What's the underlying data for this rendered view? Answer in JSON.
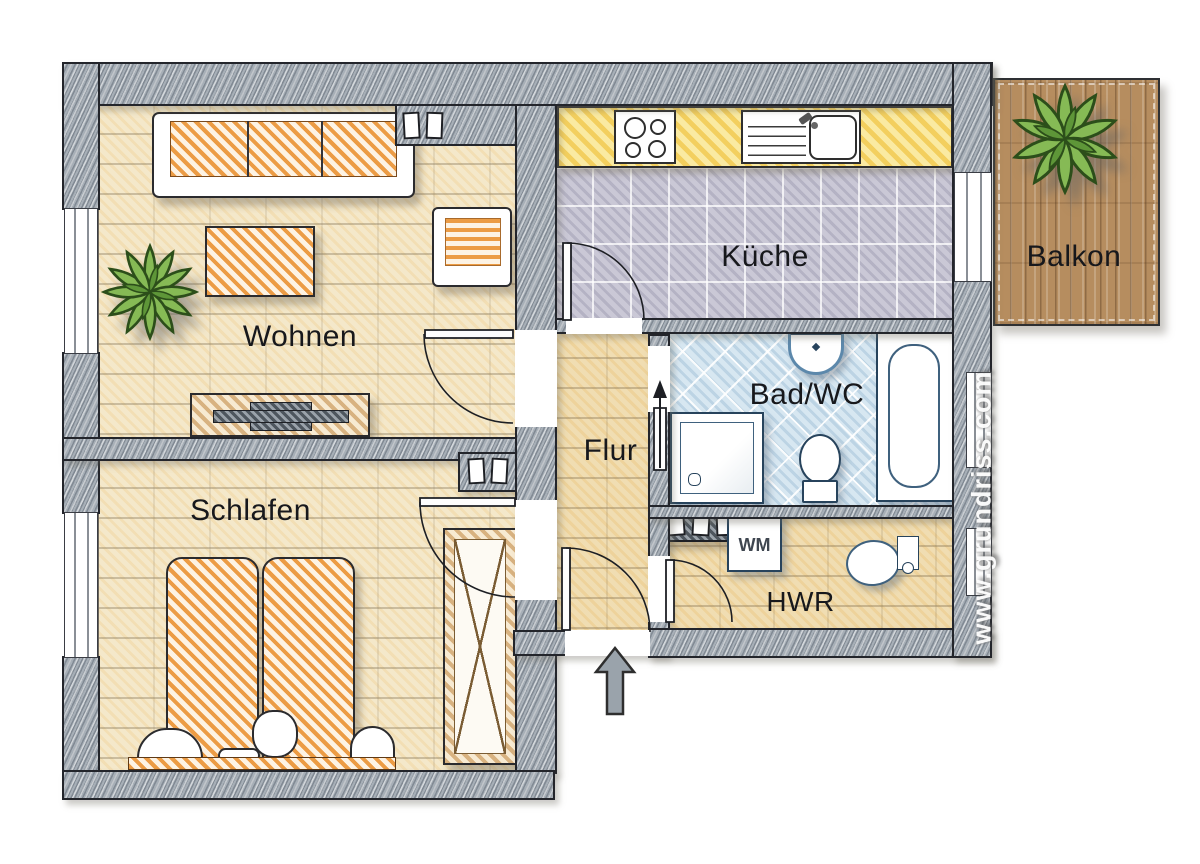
{
  "plan": {
    "type": "apartment-floor-plan",
    "watermark": "www.grundriss.com",
    "rooms": {
      "wohnen": {
        "label": "Wohnen"
      },
      "schlafen": {
        "label": "Schlafen"
      },
      "kueche": {
        "label": "Küche"
      },
      "balkon": {
        "label": "Balkon"
      },
      "bad": {
        "label": "Bad/WC"
      },
      "flur": {
        "label": "Flur"
      },
      "hwr": {
        "label": "HWR"
      }
    },
    "appliances": {
      "washing_machine": {
        "label": "WM"
      }
    },
    "colors": {
      "wall_gray": "#a7afb7",
      "floor_tan": "#f4e8ca",
      "kitchen_tile": "#cac8d6",
      "bath_tile": "#d7e7f1",
      "balcony_deck": "#b68d5f",
      "kitchen_counter_yellow": "#f3cf5e",
      "furniture_orange": "#ec9c45",
      "fixture_blue": "#8cb6d8",
      "plant_green": "#86ba55",
      "entry_arrow_gray": "#9aa3ab"
    }
  }
}
